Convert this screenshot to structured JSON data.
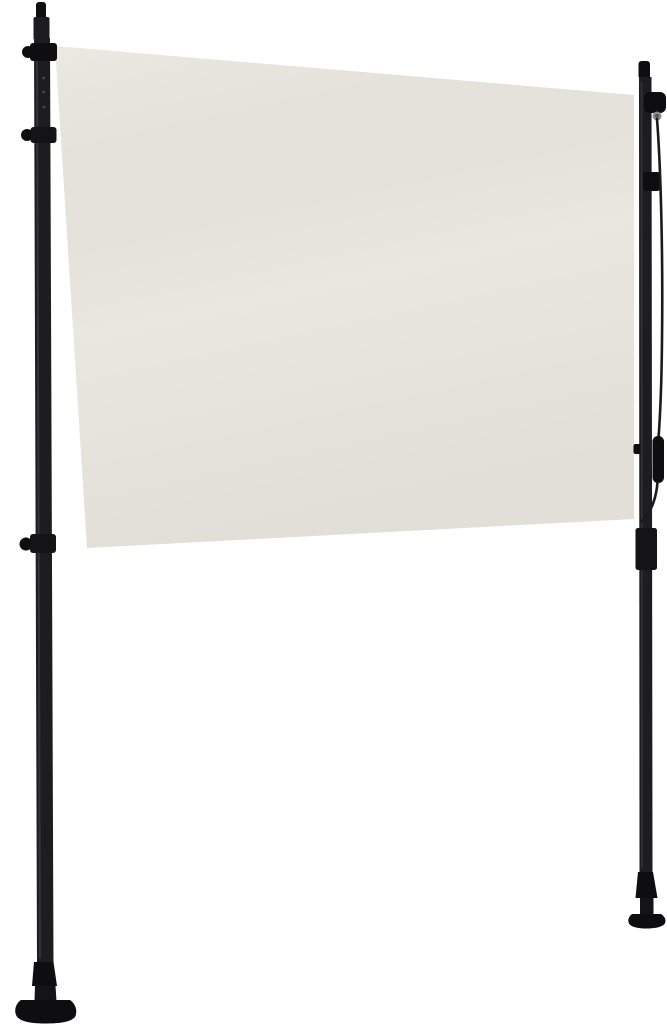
{
  "image": {
    "type": "product-photo",
    "subject": "Outdoor roller blind privacy screen with cream fabric panel and two black telescopic poles with weighted feet and a pull cord",
    "fabric_color_name": "cream",
    "frame_color_name": "black"
  },
  "colors": {
    "background": "#ffffff",
    "fabric": "#e9e7df",
    "fabric_shade": "#e2e0d5",
    "pole": "#1d1d1f",
    "pole_dark": "#141416",
    "hardware": "#0e0e10",
    "metal_pin": "#8d8d91",
    "metal_pin_core": "#55555a",
    "cord": "#1b1b1d",
    "hole_dot": "#4a4a4e"
  }
}
